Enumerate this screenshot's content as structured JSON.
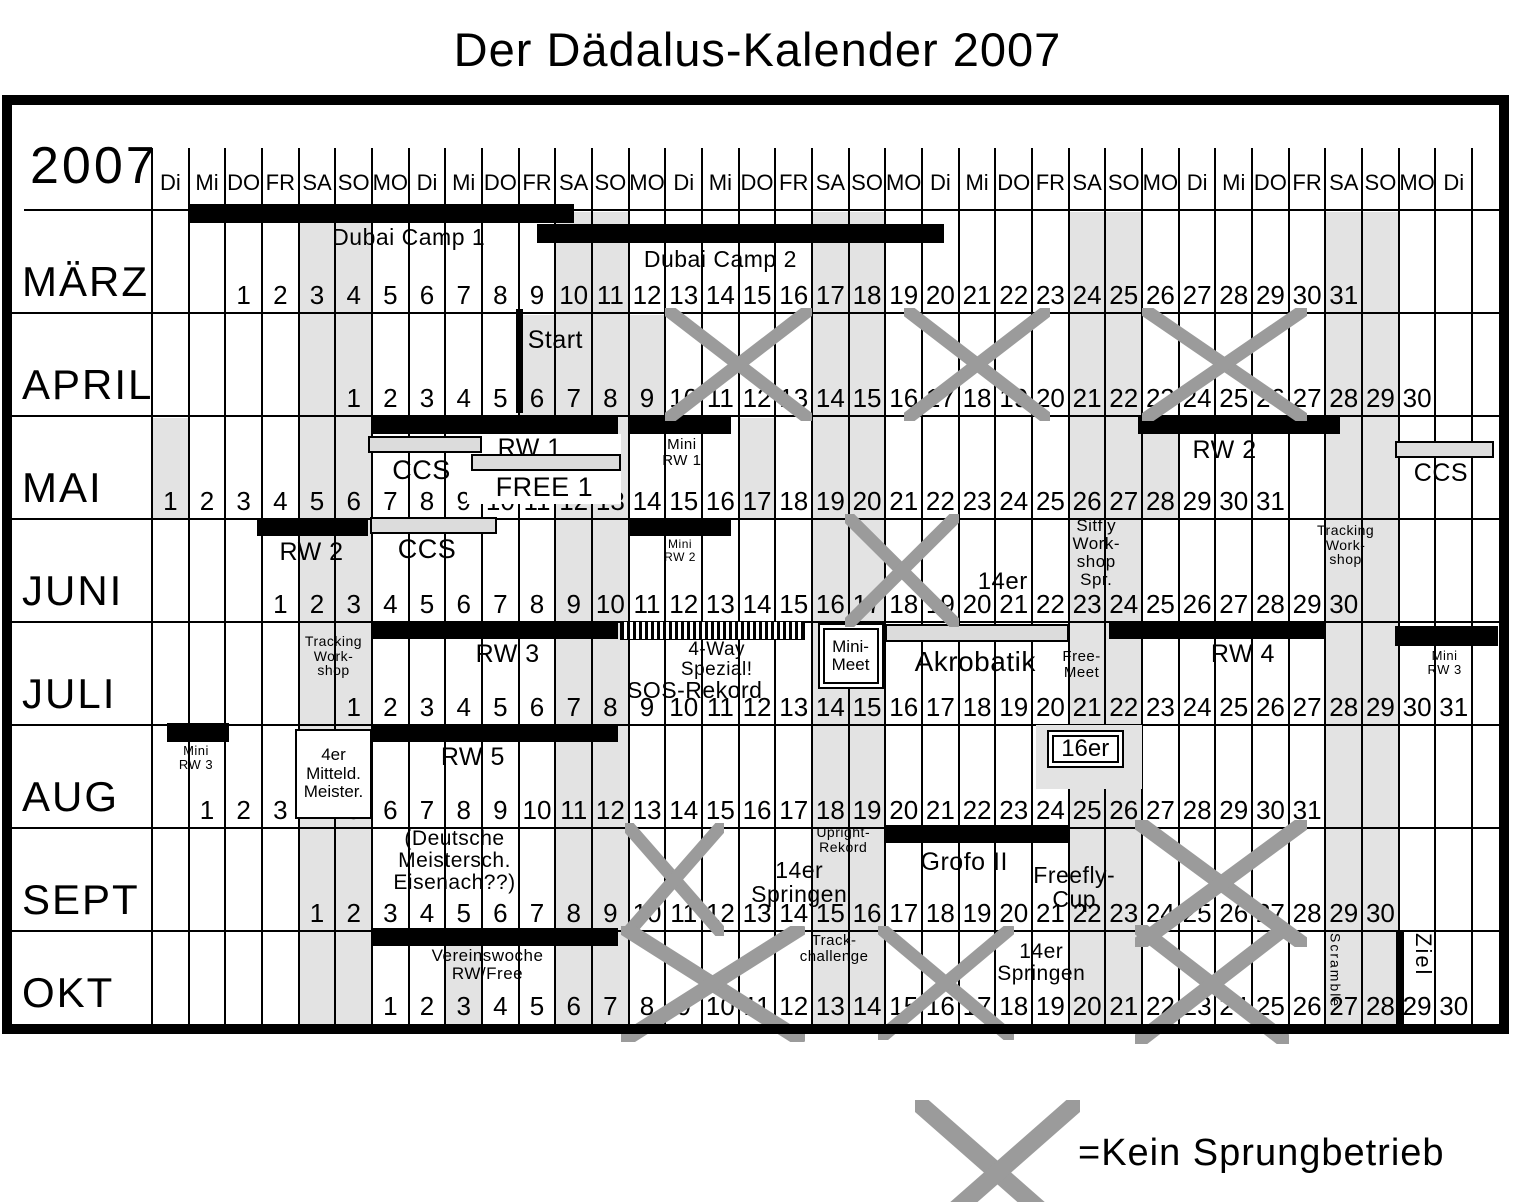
{
  "title": "Der Dädalus-Kalender 2007",
  "year_label": "2007",
  "legend": {
    "label": "=Kein Sprungbetrieb"
  },
  "colors": {
    "band": "#e3e3e3",
    "x_mark": "#9b9b9b",
    "gray_bar": "#dcdcdc",
    "bar": "#000000"
  },
  "weekday_headers": [
    "Di",
    "Mi",
    "DO",
    "FR",
    "SA",
    "SO",
    "MO",
    "Di",
    "Mi",
    "DO",
    "FR",
    "SA",
    "SO",
    "MO",
    "Di",
    "Mi",
    "DO",
    "FR",
    "SA",
    "SO",
    "MO",
    "Di",
    "Mi",
    "DO",
    "FR",
    "SA",
    "SO",
    "MO",
    "Di",
    "Mi",
    "DO",
    "FR",
    "SA",
    "SO",
    "MO",
    "Di"
  ],
  "weekend_band_cols": [
    5,
    6,
    12,
    13,
    19,
    20,
    26,
    27,
    33,
    34
  ],
  "months": [
    {
      "name": "MÄRZ",
      "start_col": 3,
      "days": 31,
      "holiday_cols": [],
      "events": [
        {
          "type": "bar",
          "from": 2,
          "to": 12.5,
          "top": -6,
          "h": 19
        },
        {
          "type": "bar",
          "from": 11.5,
          "to": 22.6,
          "top": 14,
          "h": 19
        },
        {
          "type": "label",
          "lines": [
            "Dubai Camp 1"
          ],
          "from": 4.5,
          "to": 11.5,
          "top": 15,
          "size": 23
        },
        {
          "type": "label",
          "lines": [
            "Dubai Camp 2"
          ],
          "from": 12,
          "to": 21,
          "top": 37,
          "size": 23
        }
      ]
    },
    {
      "name": "APRIL",
      "start_col": 6,
      "days": 30,
      "holiday_cols": [
        11,
        14
      ],
      "events": [
        {
          "type": "vline",
          "at": 11,
          "top": -4,
          "h": 104,
          "width": 7
        },
        {
          "type": "label",
          "lines": [
            "Start"
          ],
          "from": 10.8,
          "to": 13.2,
          "top": 14,
          "size": 25
        },
        {
          "type": "x",
          "from": 15,
          "to": 19
        },
        {
          "type": "x",
          "from": 21.5,
          "to": 25.5
        },
        {
          "type": "x",
          "from": 28,
          "to": 32.5
        }
      ]
    },
    {
      "name": "MAI",
      "start_col": 1,
      "days": 31,
      "holiday_cols": [
        1,
        17,
        28
      ],
      "events": [
        {
          "type": "bar",
          "from": 7,
          "to": 13.7,
          "top": 0,
          "h": 18
        },
        {
          "type": "whitepatch",
          "from": 9.6,
          "to": 13.8,
          "top": 18,
          "h": 70
        },
        {
          "type": "label",
          "lines": [
            "RW 1"
          ],
          "from": 9.4,
          "to": 13.2,
          "top": 19,
          "size": 25
        },
        {
          "type": "graybar",
          "from": 6.9,
          "to": 10,
          "top": 20,
          "h": 17
        },
        {
          "type": "label",
          "lines": [
            "CCS"
          ],
          "from": 6.7,
          "to": 10,
          "top": 40,
          "size": 27
        },
        {
          "type": "graybar",
          "from": 9.7,
          "to": 13.8,
          "top": 38,
          "h": 17
        },
        {
          "type": "label",
          "lines": [
            "FREE 1"
          ],
          "from": 9.4,
          "to": 14,
          "top": 57,
          "size": 27
        },
        {
          "type": "bar",
          "from": 14,
          "to": 16.8,
          "top": 0,
          "h": 18
        },
        {
          "type": "label",
          "lines": [
            "Mini",
            "RW 1"
          ],
          "from": 13.9,
          "to": 17,
          "top": 21,
          "size": 15
        },
        {
          "type": "bar",
          "from": 27.9,
          "to": 33.4,
          "top": 0,
          "h": 18
        },
        {
          "type": "label",
          "lines": [
            "RW 2"
          ],
          "from": 28.3,
          "to": 32.2,
          "top": 21,
          "size": 25
        },
        {
          "type": "graybar",
          "from": 34.9,
          "to": 37.6,
          "top": 25,
          "h": 17
        },
        {
          "type": "label",
          "lines": [
            "CCS"
          ],
          "from": 34.9,
          "to": 37.4,
          "top": 44,
          "size": 25
        }
      ]
    },
    {
      "name": "JUNI",
      "start_col": 4,
      "days": 30,
      "holiday_cols": [],
      "events": [
        {
          "type": "bar",
          "from": 3.85,
          "to": 6.9,
          "top": -1,
          "h": 18
        },
        {
          "type": "label",
          "lines": [
            "RW 2"
          ],
          "from": 3.7,
          "to": 7,
          "top": 20,
          "size": 25
        },
        {
          "type": "graybar",
          "from": 6.95,
          "to": 10.4,
          "top": -2,
          "h": 17
        },
        {
          "type": "label",
          "lines": [
            "CCS"
          ],
          "from": 6.8,
          "to": 10.2,
          "top": 16,
          "size": 27
        },
        {
          "type": "bar",
          "from": 14,
          "to": 16.8,
          "top": -1,
          "h": 18
        },
        {
          "type": "label",
          "lines": [
            "Mini",
            "RW 2"
          ],
          "from": 13.8,
          "to": 17,
          "top": 19,
          "size": 12
        },
        {
          "type": "x",
          "from": 19.9,
          "to": 23
        },
        {
          "type": "label",
          "lines": [
            "14er"
          ],
          "from": 23,
          "to": 25.4,
          "top": 50,
          "size": 24
        },
        {
          "type": "label",
          "lines": [
            "Sitfly",
            "Work-",
            "shop",
            "Spr."
          ],
          "from": 25.3,
          "to": 28.2,
          "top": -2,
          "size": 17
        },
        {
          "type": "label",
          "lines": [
            "Tracking",
            "Work-",
            "shop"
          ],
          "from": 32.3,
          "to": 34.8,
          "top": 4,
          "size": 14
        }
      ]
    },
    {
      "name": "JULI",
      "start_col": 6,
      "days": 31,
      "holiday_cols": [],
      "events": [
        {
          "type": "label",
          "lines": [
            "Tracking",
            "Work-",
            "shop"
          ],
          "from": 4.9,
          "to": 7,
          "top": 12,
          "size": 14
        },
        {
          "type": "bar",
          "from": 7,
          "to": 13.7,
          "top": -1,
          "h": 18
        },
        {
          "type": "label",
          "lines": [
            "RW 3"
          ],
          "from": 8.6,
          "to": 12.8,
          "top": 19,
          "size": 25
        },
        {
          "type": "hatch",
          "from": 13.75,
          "to": 18.8,
          "top": -1,
          "h": 19
        },
        {
          "type": "label",
          "lines": [
            "4-Way",
            "Spezial!"
          ],
          "from": 13.8,
          "to": 19,
          "top": 18,
          "size": 19
        },
        {
          "type": "label",
          "lines": [
            "SOS-Rekord"
          ],
          "from": 12.4,
          "to": 19.2,
          "top": 56,
          "size": 23
        },
        {
          "type": "box",
          "lines": [
            "Mini-",
            "Meet"
          ],
          "from": 19.15,
          "to": 20.95,
          "top": 1,
          "h": 66,
          "size": 17,
          "border": "double"
        },
        {
          "type": "graybar",
          "from": 21,
          "to": 26,
          "top": 2,
          "h": 18
        },
        {
          "type": "label",
          "lines": [
            "Akrobatik"
          ],
          "from": 20.7,
          "to": 26.2,
          "top": 25,
          "size": 28
        },
        {
          "type": "label",
          "lines": [
            "Free-",
            "Meet"
          ],
          "from": 25.6,
          "to": 27.1,
          "top": 27,
          "size": 15
        },
        {
          "type": "bar",
          "from": 27.1,
          "to": 33,
          "top": -1,
          "h": 18
        },
        {
          "type": "label",
          "lines": [
            "RW 4"
          ],
          "from": 29,
          "to": 32.5,
          "top": 19,
          "size": 25
        },
        {
          "type": "bar",
          "from": 34.9,
          "to": 37.7,
          "top": 4,
          "h": 20
        },
        {
          "type": "label",
          "lines": [
            "Mini",
            "RW 3"
          ],
          "from": 35,
          "to": 37.5,
          "top": 27,
          "size": 13
        }
      ]
    },
    {
      "name": "AUG",
      "start_col": 2,
      "days": 31,
      "holiday_cols": [],
      "events": [
        {
          "type": "bar",
          "from": 1.4,
          "to": 3.1,
          "top": -2,
          "h": 19
        },
        {
          "type": "label",
          "lines": [
            "Mini",
            "RW 3"
          ],
          "from": 1.2,
          "to": 3.2,
          "top": 19,
          "size": 13
        },
        {
          "type": "box",
          "lines": [
            "4er",
            "Mitteld.",
            "Meister."
          ],
          "from": 4.9,
          "to": 7,
          "top": 4,
          "h": 90,
          "size": 17,
          "border": "single"
        },
        {
          "type": "bar",
          "from": 7,
          "to": 13.7,
          "top": -1,
          "h": 18
        },
        {
          "type": "label",
          "lines": [
            "RW 5"
          ],
          "from": 8,
          "to": 11.5,
          "top": 19,
          "size": 25
        },
        {
          "type": "patch",
          "from": 25.1,
          "to": 28,
          "top": 0,
          "h": 64
        },
        {
          "type": "box",
          "lines": [
            "16er"
          ],
          "from": 25.4,
          "to": 27.5,
          "top": 5,
          "h": 38,
          "size": 24,
          "border": "double"
        }
      ]
    },
    {
      "name": "SEPT",
      "start_col": 5,
      "days": 30,
      "holiday_cols": [],
      "events": [
        {
          "type": "label",
          "lines": [
            "(Deutsche",
            "Meistersch.",
            "Eisenach??)"
          ],
          "from": 6.3,
          "to": 12.2,
          "top": 0,
          "size": 21
        },
        {
          "type": "x",
          "from": 13.9,
          "to": 16.6
        },
        {
          "type": "label",
          "lines": [
            "Upright-",
            "Rekord"
          ],
          "from": 18.7,
          "to": 21,
          "top": -3,
          "size": 14
        },
        {
          "type": "label",
          "lines": [
            "14er",
            "Springen"
          ],
          "from": 16.3,
          "to": 21,
          "top": 30,
          "size": 23
        },
        {
          "type": "bar",
          "from": 21,
          "to": 26,
          "top": -3,
          "h": 18
        },
        {
          "type": "label",
          "lines": [
            "Grofo II"
          ],
          "from": 21,
          "to": 25.3,
          "top": 21,
          "size": 25
        },
        {
          "type": "label",
          "lines": [
            "Freefly-",
            "Cup"
          ],
          "from": 24.3,
          "to": 28,
          "top": 35,
          "size": 23
        },
        {
          "type": "x",
          "from": 27.8,
          "to": 32.5,
          "topSpill": 8,
          "bottomSpill": 16,
          "sw": 15
        }
      ]
    },
    {
      "name": "OKT",
      "start_col": 7,
      "days": 30,
      "holiday_cols": [
        9
      ],
      "events": [
        {
          "type": "bar",
          "from": 7,
          "to": 13.7,
          "top": -3,
          "h": 18
        },
        {
          "type": "label",
          "lines": [
            "Vereinswoche",
            "RW/Free"
          ],
          "from": 7.3,
          "to": 13,
          "top": 16,
          "size": 17
        },
        {
          "type": "x",
          "from": 13.8,
          "to": 18.8,
          "bottomSpill": 18,
          "sw": 15
        },
        {
          "type": "label",
          "lines": [
            "Track-",
            "challenge"
          ],
          "from": 18.2,
          "to": 21,
          "top": 2,
          "size": 15
        },
        {
          "type": "x",
          "from": 20.8,
          "to": 24.5,
          "bottomSpill": 16
        },
        {
          "type": "label",
          "lines": [
            "14er",
            "Springen"
          ],
          "from": 23.3,
          "to": 27.2,
          "top": 10,
          "size": 21
        },
        {
          "type": "x",
          "from": 27.8,
          "to": 32,
          "topSpill": 6,
          "bottomSpill": 20,
          "sw": 15
        },
        {
          "type": "vtext",
          "text": "Scramble",
          "at": 33,
          "top": 2,
          "size": 14
        },
        {
          "type": "vline",
          "at": 35,
          "top": 0,
          "h": 93,
          "width": 8
        },
        {
          "type": "vtext",
          "text": "Ziel",
          "at": 35.25,
          "top": 2,
          "size": 22
        }
      ]
    }
  ]
}
